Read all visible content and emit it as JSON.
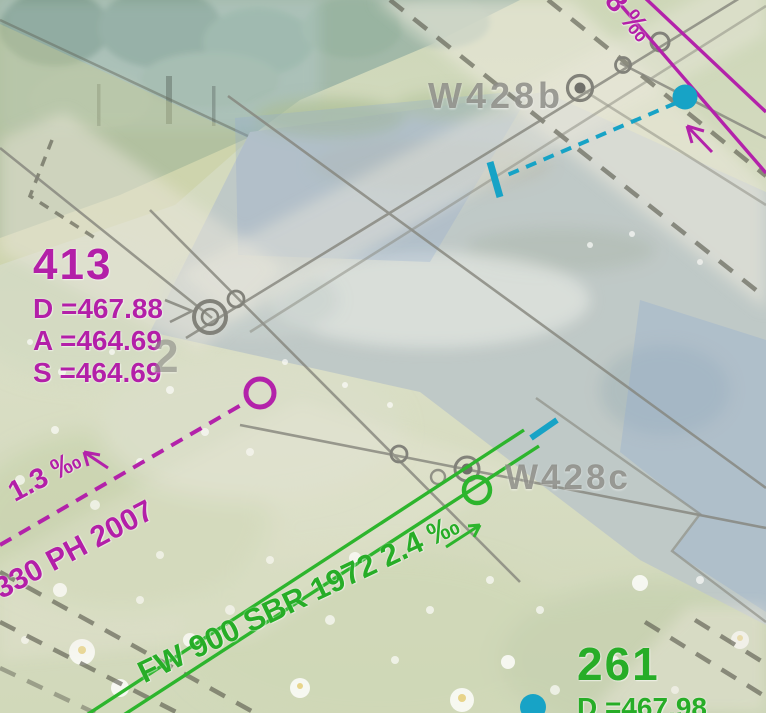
{
  "map": {
    "type": "utility-cadastre-overlay-on-orthophoto",
    "labels": {
      "node413": {
        "id": "413",
        "line1": "D =467.88",
        "line2": "A =464.69",
        "line3": "S =464.69"
      },
      "node261": {
        "id": "261",
        "line1": "D =467.98"
      },
      "manhole_b": "W428b",
      "manhole_c": "W428c",
      "stray_digit": "2",
      "slope_left": "1.3 ‰",
      "pipe_left": "330 PH 2007",
      "pipe_green": "FW 900 SBR 1972 2.4 ‰",
      "slope_top_right": "8 ‰"
    },
    "colors": {
      "pressure_pipe_magenta": "#b31fa8",
      "sewer_green": "#2db52d",
      "water_cyan": "#17a3c6",
      "network_gray": "#85857c",
      "boundary_dash_dark": "#57574b",
      "label_gray": "#94948c"
    },
    "icons": {
      "manhole_double_circle": "manhole-symbol",
      "manhole_filled_circle": "manhole-filled-symbol",
      "pipe_end_tee": "pipe-end-tee-marker",
      "flow_arrow": "flow-direction-arrow",
      "node_ring_magenta": "pressure-node-ring",
      "node_ring_green": "sewer-node-ring",
      "water_node_dot": "water-node-dot"
    }
  }
}
